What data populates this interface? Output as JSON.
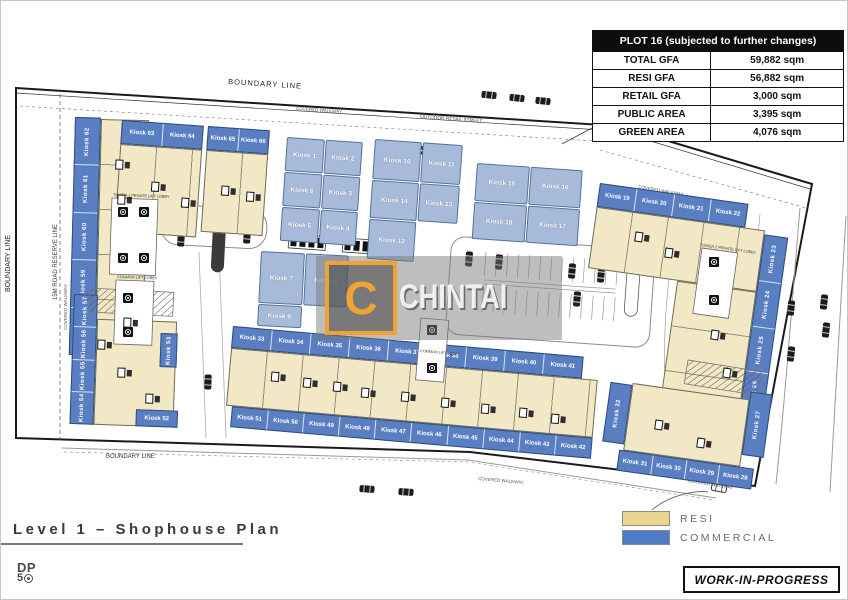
{
  "watermark": {
    "letter": "C",
    "name": "CHINTAI"
  },
  "info_table": {
    "header": "PLOT 16 (subjected to further changes)",
    "rows": [
      {
        "label": "TOTAL GFA",
        "value": "59,882 sqm"
      },
      {
        "label": "RESI GFA",
        "value": "56,882 sqm"
      },
      {
        "label": "RETAIL GFA",
        "value": "3,000 sqm"
      },
      {
        "label": "PUBLIC AREA",
        "value": "3,395 sqm"
      },
      {
        "label": "GREEN AREA",
        "value": "4,076 sqm"
      }
    ]
  },
  "legend": {
    "items": [
      {
        "label": "RESI",
        "color": "#E9D58E"
      },
      {
        "label": "COMMERCIAL",
        "color": "#4D7CC4"
      }
    ]
  },
  "footer": {
    "plan_title": "Level 1 – Shophouse Plan",
    "logo_top": "DP",
    "logo_bottom": "5",
    "status": "WORK-IN-PROGRESS"
  },
  "plan": {
    "labels": {
      "boundary": "BOUNDARY LINE",
      "road_reserve": "15M ROAD RESERVE LINE",
      "outdoor_retail_street": "OUTDOOR RETAIL STREET",
      "covered_walkway": "COVERED WALKWAY",
      "lift_lobbies": [
        "TOWER 1 PRIVATE LIFT LOBBY",
        "COMMON LIFT LOBBY",
        "TOWER 2 PRIVATE LIFT LOBBY",
        "COMMON LIFT LOBBY"
      ]
    },
    "blocks": {
      "west_strip": [
        "Kiosk 62",
        "Kiosk 61",
        "Kiosk 60",
        "Kiosk 59",
        "Kiosk 58"
      ],
      "north_wing_a": [
        "Kiosk 63",
        "Kiosk 64"
      ],
      "north_wing_b": [
        "Kiosk 65",
        "Kiosk 66"
      ],
      "retail_cluster_1": [
        "Kiosk 1",
        "Kiosk 2",
        "Kiosk 6",
        "Kiosk 3",
        "Kiosk 5",
        "Kiosk 4"
      ],
      "retail_cluster_2": [
        "Kiosk 7",
        "Kiosk 8",
        "Kiosk 9"
      ],
      "retail_cluster_3": [
        "Kiosk 10",
        "Kiosk 11",
        "Kiosk 14",
        "Kiosk 13",
        "Kiosk 12"
      ],
      "retail_cluster_4": [
        "Kiosk 15",
        "Kiosk 16",
        "Kiosk 18",
        "Kiosk 17"
      ],
      "northeast_top": [
        "Kiosk 19",
        "Kiosk 20",
        "Kiosk 21",
        "Kiosk 22"
      ],
      "east_strip": [
        "Kiosk 23",
        "Kiosk 24",
        "Kiosk 25",
        "Kiosk 26"
      ],
      "southeast_left": [
        "Kiosk 32"
      ],
      "southeast_right": [
        "Kiosk 27"
      ],
      "southeast_bottom": [
        "Kiosk 31",
        "Kiosk 30",
        "Kiosk 29",
        "Kiosk 28"
      ],
      "south_band_top": [
        "Kiosk 33",
        "Kiosk 34",
        "Kiosk 35",
        "Kiosk 36",
        "Kiosk 37",
        "Kiosk 38",
        "Kiosk 39",
        "Kiosk 40",
        "Kiosk 41"
      ],
      "south_band_bottom": [
        "Kiosk 51",
        "Kiosk 50",
        "Kiosk 49",
        "Kiosk 48",
        "Kiosk 47",
        "Kiosk 46",
        "Kiosk 45",
        "Kiosk 44",
        "Kiosk 43",
        "Kiosk 42"
      ],
      "southwest_strip": [
        "Kiosk 57",
        "Kiosk 56",
        "Kiosk 55",
        "Kiosk 54"
      ],
      "southwest_right": [
        "Kiosk 53"
      ],
      "southwest_bottom": [
        "Kiosk 52"
      ]
    }
  },
  "colors": {
    "resi": "#F2E8C5",
    "commercial_strip": "#5A7EC2",
    "commercial_cell": "#A7BAD9",
    "accent_orange": "#F0A232"
  }
}
